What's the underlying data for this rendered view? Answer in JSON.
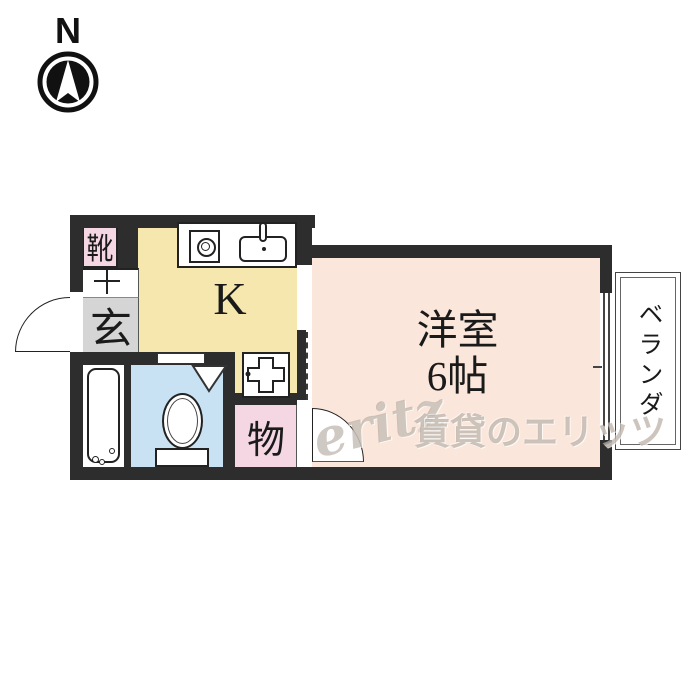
{
  "compass": {
    "direction_label": "N"
  },
  "floorplan": {
    "rooms": {
      "kitchen": {
        "label": "K"
      },
      "western_room": {
        "name_label": "洋室",
        "size_label": "6帖"
      },
      "storage": {
        "label": "物"
      },
      "entrance": {
        "label": "玄"
      },
      "shoe_cabinet": {
        "label": "靴"
      },
      "veranda": {
        "label": "ベランダ"
      }
    },
    "colors": {
      "wall": "#2d2d2d",
      "kitchen": "#f5e7ae",
      "western_room": "#fae6da",
      "toilet": "#c8e2f3",
      "pink_rooms": "#f5d7e3",
      "entrance_floor": "#d5d5d5"
    },
    "icons": {
      "compass": "north-arrow-in-circle",
      "stove": "single-burner",
      "sink": "kitchen-sink-with-faucet",
      "toilet": "toilet-bowl-with-tank",
      "bathtub": "bathtub-with-drain",
      "washing_pan": "washing-machine-pan-cross"
    }
  },
  "watermark": {
    "logo_text": "eritz",
    "text": "賃貸のエリッツ"
  }
}
